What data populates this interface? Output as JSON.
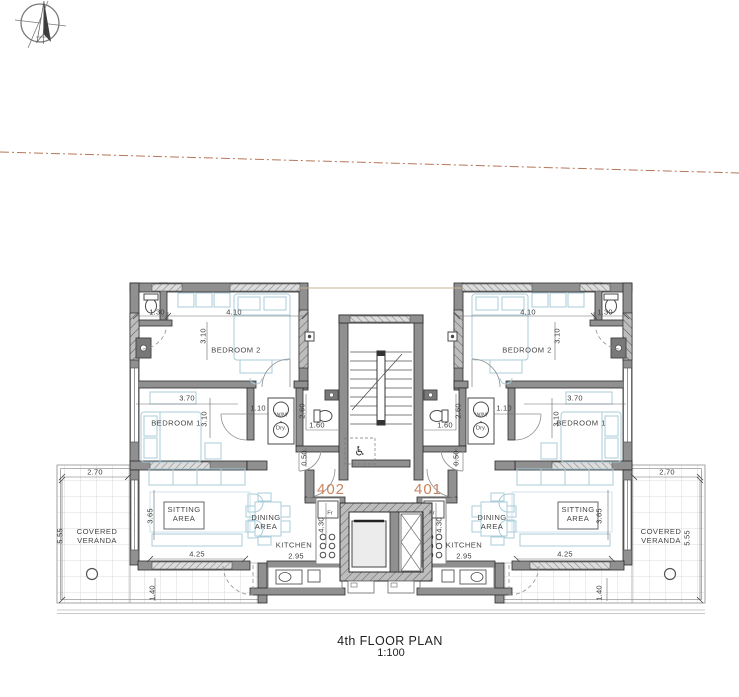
{
  "meta": {
    "title": "4th FLOOR PLAN",
    "scale": "1:100"
  },
  "units": {
    "left": "402",
    "right": "401"
  },
  "colors": {
    "unit_accent": "#c9855f",
    "boundary_dash_line": "#b5775a",
    "furniture_blue": "#a9cdda",
    "wall_dark": "#2b2b2b",
    "wall_fill": "#909090"
  },
  "icons": {
    "north_arrow": "north-arrow-compass",
    "wheelchair": "♿"
  },
  "plan_labels": [
    {
      "n": "dim-bath-width-left",
      "t": "1.30",
      "x": 157,
      "y": 313,
      "c": "c-d"
    },
    {
      "n": "dim-bedroom2-width-left",
      "t": "4.10",
      "x": 234,
      "y": 313,
      "c": "c-d"
    },
    {
      "n": "dim-bedroom2-depth-left",
      "t": "3.10",
      "x": 204,
      "y": 336,
      "c": "c-v"
    },
    {
      "n": "dim-bedroom1-width-left",
      "t": "3.70",
      "x": 187,
      "y": 399,
      "c": "c-d"
    },
    {
      "n": "dim-bedroom1-depth-left",
      "t": "3.10",
      "x": 205,
      "y": 419,
      "c": "c-v"
    },
    {
      "n": "dim-hall-left",
      "t": "1.10",
      "x": 258,
      "y": 409,
      "c": "c-d"
    },
    {
      "n": "dim-bath2-depth-left",
      "t": "2.60",
      "x": 303,
      "y": 411,
      "c": "c-v"
    },
    {
      "n": "dim-bath2-width-left",
      "t": "1.60",
      "x": 317,
      "y": 426,
      "c": "c-d"
    },
    {
      "n": "dim-entry-left",
      "t": "0.50",
      "x": 305,
      "y": 458,
      "c": "c-v"
    },
    {
      "n": "dim-veranda-top-left",
      "t": "2.70",
      "x": 95,
      "y": 473,
      "c": "c-d"
    },
    {
      "n": "dim-veranda-side-left",
      "t": "5.55",
      "x": 61,
      "y": 536,
      "c": "c-v"
    },
    {
      "n": "dim-sitting-depth-left",
      "t": "3.65",
      "x": 151,
      "y": 516,
      "c": "c-v"
    },
    {
      "n": "dim-sitting-width-left",
      "t": "4.25",
      "x": 197,
      "y": 555,
      "c": "c-d"
    },
    {
      "n": "dim-kitchen-depth-left",
      "t": "4.30",
      "x": 322,
      "y": 525,
      "c": "c-v"
    },
    {
      "n": "dim-kitchen-width-left",
      "t": "2.95",
      "x": 296,
      "y": 557,
      "c": "c-d"
    },
    {
      "n": "dim-veranda-bottom-left",
      "t": "1.40",
      "x": 153,
      "y": 593,
      "c": "c-v"
    },
    {
      "n": "dim-bath-width-right",
      "t": "1.30",
      "x": 605,
      "y": 313,
      "c": "c-d"
    },
    {
      "n": "dim-bedroom2-width-right",
      "t": "4.10",
      "x": 528,
      "y": 313,
      "c": "c-d"
    },
    {
      "n": "dim-bedroom2-depth-right",
      "t": "3.10",
      "x": 558,
      "y": 336,
      "c": "c-v"
    },
    {
      "n": "dim-bedroom1-width-right",
      "t": "3.70",
      "x": 575,
      "y": 399,
      "c": "c-d"
    },
    {
      "n": "dim-bedroom1-depth-right",
      "t": "3.10",
      "x": 557,
      "y": 419,
      "c": "c-v"
    },
    {
      "n": "dim-hall-right",
      "t": "1.10",
      "x": 504,
      "y": 409,
      "c": "c-d"
    },
    {
      "n": "dim-bath2-depth-right",
      "t": "2.60",
      "x": 459,
      "y": 411,
      "c": "c-v"
    },
    {
      "n": "dim-bath2-width-right",
      "t": "1.60",
      "x": 445,
      "y": 426,
      "c": "c-d"
    },
    {
      "n": "dim-entry-right",
      "t": "0.50",
      "x": 457,
      "y": 458,
      "c": "c-v"
    },
    {
      "n": "dim-veranda-top-right",
      "t": "2.70",
      "x": 667,
      "y": 473,
      "c": "c-d"
    },
    {
      "n": "dim-veranda-side-right",
      "t": "5.55",
      "x": 688,
      "y": 538,
      "c": "c-v"
    },
    {
      "n": "dim-sitting-depth-right",
      "t": "3.65",
      "x": 600,
      "y": 516,
      "c": "c-v"
    },
    {
      "n": "dim-sitting-width-right",
      "t": "4.25",
      "x": 565,
      "y": 555,
      "c": "c-d"
    },
    {
      "n": "dim-kitchen-depth-right",
      "t": "4.30",
      "x": 440,
      "y": 525,
      "c": "c-v"
    },
    {
      "n": "dim-kitchen-width-right",
      "t": "2.95",
      "x": 464,
      "y": 557,
      "c": "c-d"
    },
    {
      "n": "dim-veranda-bottom-right",
      "t": "1.40",
      "x": 600,
      "y": 593,
      "c": "c-v"
    },
    {
      "n": "room-bedroom2-left",
      "t": "BEDROOM  2",
      "x": 236,
      "y": 351,
      "c": "c-r"
    },
    {
      "n": "room-bedroom1-left",
      "t": "BEDROOM  1",
      "x": 176,
      "y": 424,
      "c": "c-r"
    },
    {
      "n": "room-sitting-left",
      "t": "SITTING\nAREA",
      "x": 184,
      "y": 515,
      "c": "c-r"
    },
    {
      "n": "room-dining-left",
      "t": "DINING\nAREA",
      "x": 266,
      "y": 523,
      "c": "c-r"
    },
    {
      "n": "room-kitchen-left",
      "t": "KITCHEN",
      "x": 294,
      "y": 546,
      "c": "c-r"
    },
    {
      "n": "room-veranda-left",
      "t": "COVERED\nVERANDA",
      "x": 97,
      "y": 537,
      "c": "c-r"
    },
    {
      "n": "room-bedroom2-right",
      "t": "BEDROOM  2",
      "x": 527,
      "y": 351,
      "c": "c-r"
    },
    {
      "n": "room-bedroom1-right",
      "t": "BEDROOM  1",
      "x": 581,
      "y": 424,
      "c": "c-r"
    },
    {
      "n": "room-sitting-right",
      "t": "SITTING\nAREA",
      "x": 578,
      "y": 515,
      "c": "c-r"
    },
    {
      "n": "room-dining-right",
      "t": "DINING\nAREA",
      "x": 492,
      "y": 523,
      "c": "c-r"
    },
    {
      "n": "room-kitchen-right",
      "t": "KITCHEN",
      "x": 464,
      "y": 546,
      "c": "c-r"
    },
    {
      "n": "room-veranda-right",
      "t": "COVERED\nVERANDA",
      "x": 661,
      "y": 537,
      "c": "c-r"
    },
    {
      "n": "appliance-washer-left",
      "t": "W/M",
      "x": 281,
      "y": 416,
      "c": "c-a"
    },
    {
      "n": "appliance-dryer-left",
      "t": "Dry.",
      "x": 281,
      "y": 429,
      "c": "c-a"
    },
    {
      "n": "appliance-fridge-left",
      "t": "Fr",
      "x": 330,
      "y": 514,
      "c": "c-a"
    },
    {
      "n": "appliance-washer-right",
      "t": "W/M",
      "x": 481,
      "y": 416,
      "c": "c-a"
    },
    {
      "n": "appliance-dryer-right",
      "t": "Dry.",
      "x": 481,
      "y": 429,
      "c": "c-a"
    },
    {
      "n": "appliance-fridge-right",
      "t": "Fr",
      "x": 432,
      "y": 514,
      "c": "c-a"
    },
    {
      "n": "unit-402-label",
      "t": "402",
      "x": 331,
      "y": 490,
      "c": "c-u"
    },
    {
      "n": "unit-401-label",
      "t": "401",
      "x": 428,
      "y": 490,
      "c": "c-u"
    },
    {
      "n": "wheelchair-icon",
      "t": "♿",
      "x": 360,
      "y": 451,
      "c": "c-i"
    }
  ]
}
